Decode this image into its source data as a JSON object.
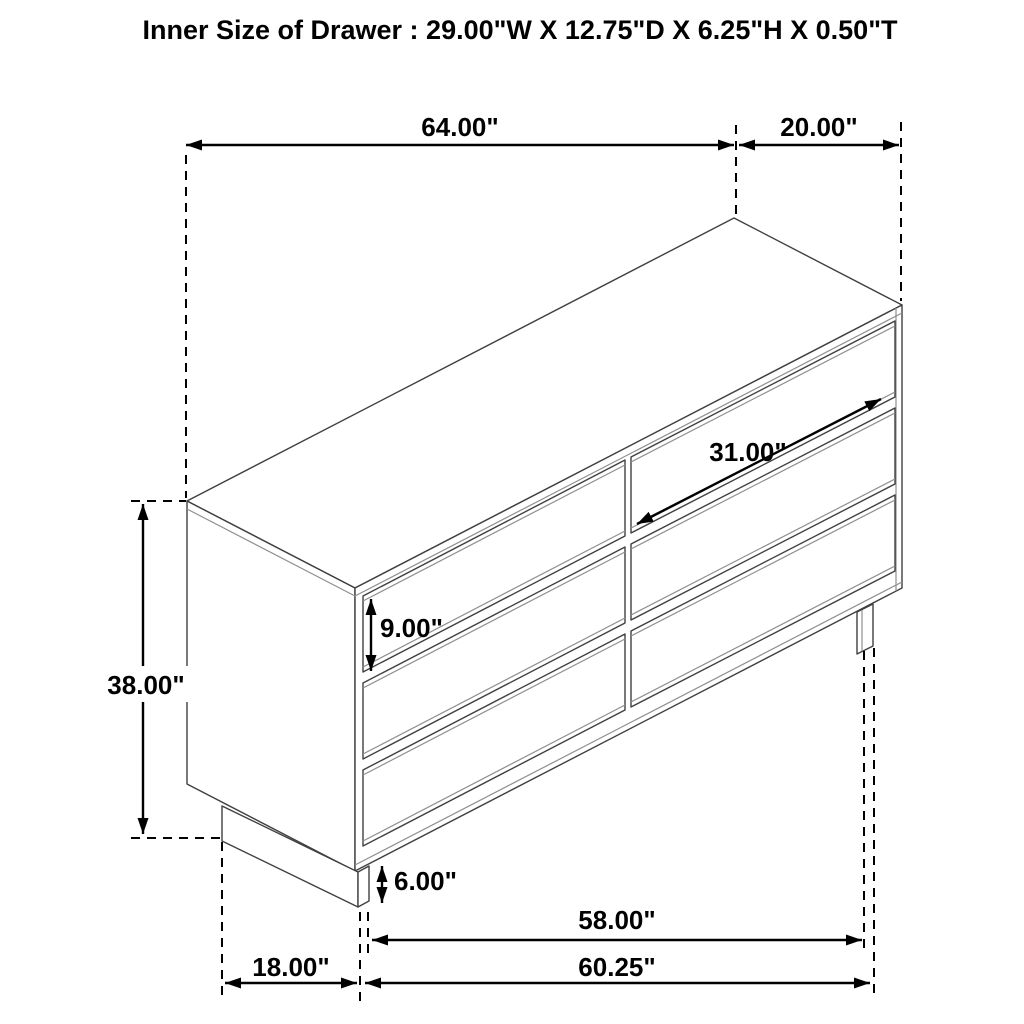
{
  "title": "Inner Size of Drawer : 29.00\"W X 12.75\"D X 6.25\"H X 0.50\"T",
  "dimensions": {
    "overall_width": "64.00\"",
    "overall_depth": "20.00\"",
    "overall_height": "38.00\"",
    "drawer_front_height": "9.00\"",
    "drawer_front_width": "31.00\"",
    "base_height": "6.00\"",
    "base_depth": "18.00\"",
    "leg_spacing": "58.00\"",
    "base_width": "60.25\""
  },
  "colors": {
    "background": "#ffffff",
    "dimension_line": "#000000",
    "furniture_line": "#404040",
    "text": "#000000"
  }
}
